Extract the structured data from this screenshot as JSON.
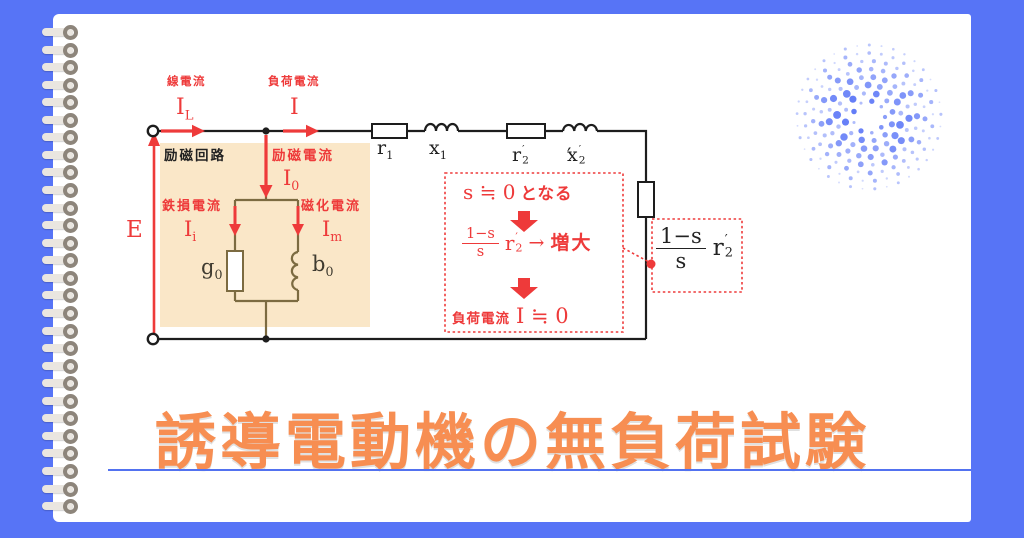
{
  "page": {
    "title": "誘導電動機の無負荷試験"
  },
  "colors": {
    "bg": "#5774f6",
    "page": "#ffffff",
    "ink": "#1d1d1d",
    "red": "#ee3a3a",
    "orange": "#f78e52",
    "beige": "#fae7c8",
    "olive": "#7c6b41",
    "line-blue": "#5272f0",
    "dot-blue": "#5b76f7",
    "ring-bar": "#eae6e0",
    "ring-loop": "#8d857b"
  },
  "circuit": {
    "line_current_caption": "線電流",
    "line_current_symbol": "I",
    "line_current_sub": "L",
    "load_current_caption": "負荷電流",
    "load_current_symbol": "I",
    "excitation_circuit_caption": "励磁回路",
    "excitation_current_caption": "励磁電流",
    "excitation_current_symbol": "I",
    "excitation_current_sub": "0",
    "iron_loss_caption": "鉄損電流",
    "iron_loss_symbol": "I",
    "iron_loss_sub": "i",
    "magnetizing_caption": "磁化電流",
    "magnetizing_symbol": "I",
    "magnetizing_sub": "m",
    "emf_symbol": "E",
    "conductance_symbol": "g",
    "conductance_sub": "0",
    "susceptance_symbol": "b",
    "susceptance_sub": "0",
    "r1_symbol": "r",
    "r1_sub": "1",
    "x1_symbol": "x",
    "x1_sub": "1",
    "r2_symbol": "r",
    "r2_sub": "2",
    "r2_prime": "′",
    "x2_symbol": "x",
    "x2_sub": "2",
    "x2_prime": "′"
  },
  "annotation_box": {
    "line1_math": "s ≒ 0",
    "line1_text": "となる",
    "fraction_numerator": "1−s",
    "fraction_denominator": "s",
    "fraction_symbol": "r",
    "fraction_sub": "2",
    "fraction_prime": "′",
    "arrow": "→",
    "line2_text": "増大",
    "line3_caption": "負荷電流",
    "line3_math": "I ≒ 0"
  },
  "load_box": {
    "numerator": "1−s",
    "denominator": "s",
    "symbol": "r",
    "sub": "2",
    "prime": "′"
  }
}
